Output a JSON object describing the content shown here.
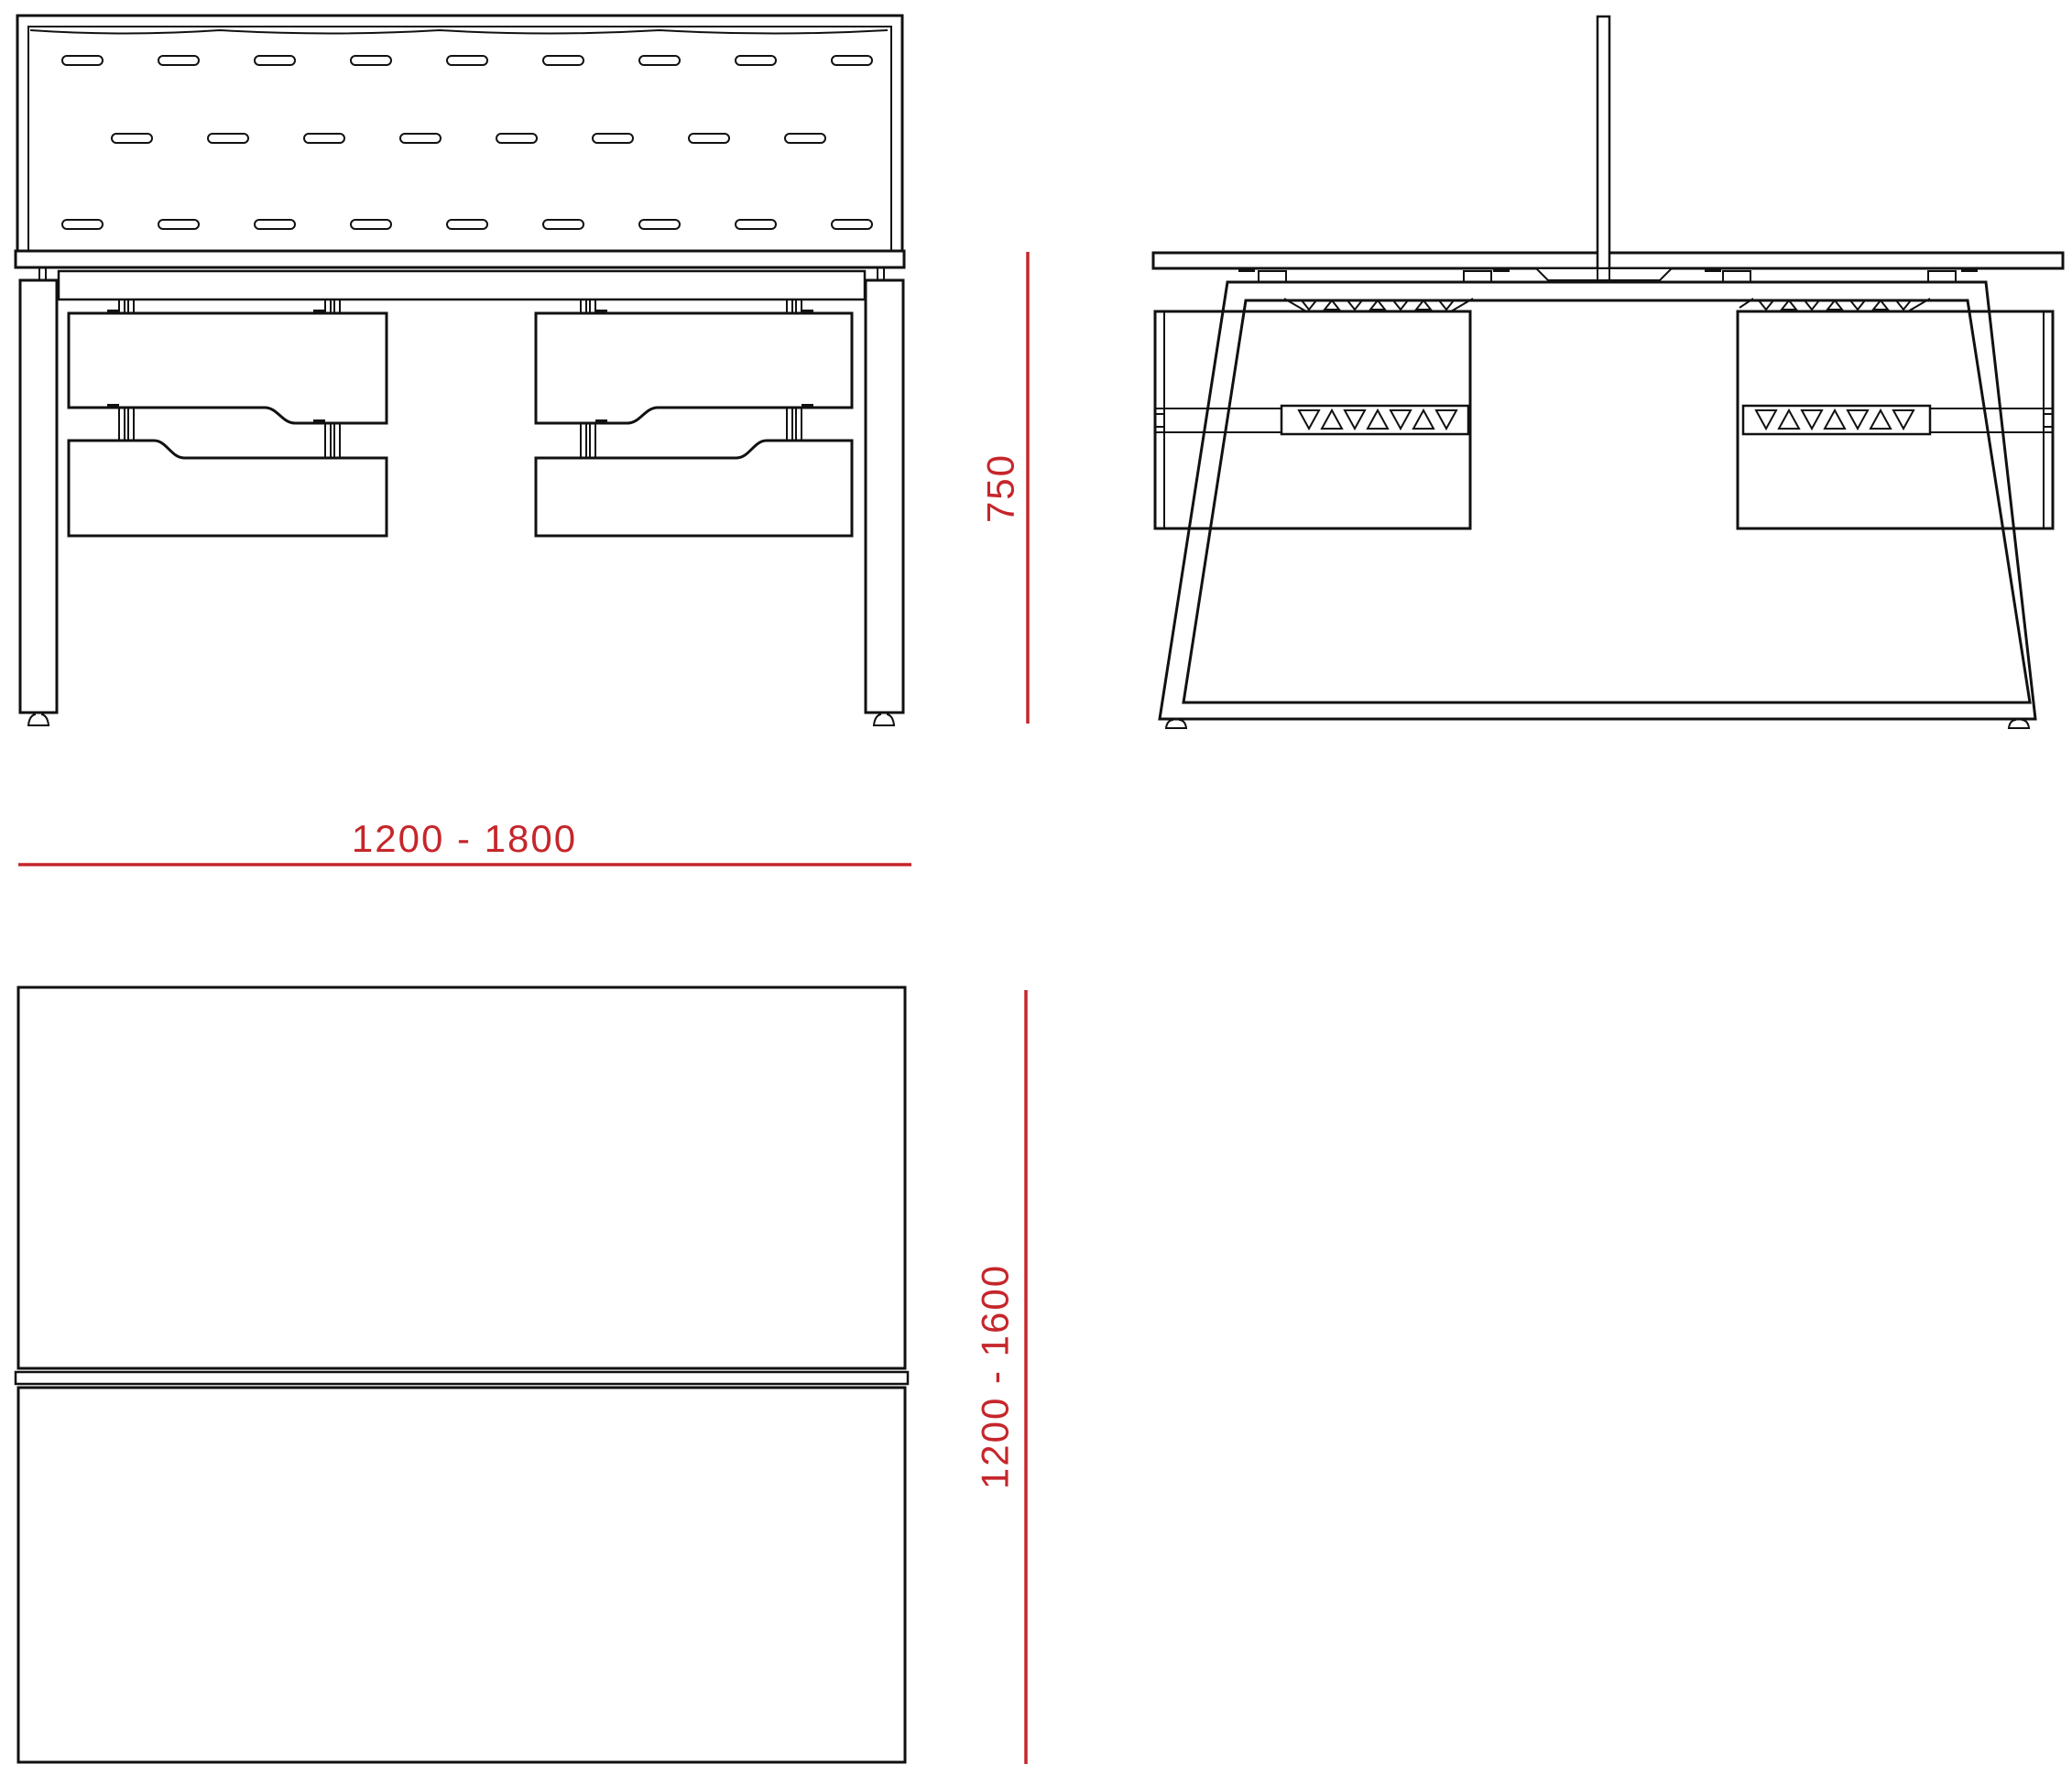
{
  "drawing": {
    "title_present": false,
    "line_color": "#111111",
    "accent_color": "#c5262b",
    "background_color": "#ffffff",
    "dimensions": {
      "height_label": "750",
      "width_label": "1200 - 1800",
      "depth_label": "1200 - 1600"
    }
  }
}
